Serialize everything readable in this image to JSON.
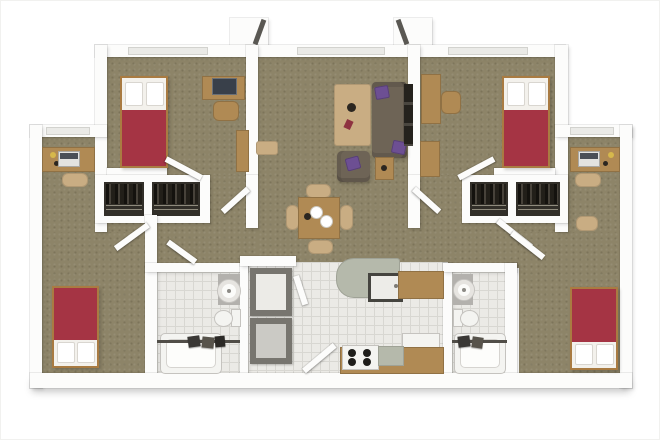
{
  "meta": {
    "description": "3D top-down architectural rendering of a four-bedroom apartment floor plan with central shared living room, dining area, kitchen, two bathrooms, closets and a stacked laundry unit",
    "view": "overhead isometric floor plan, no text labels"
  },
  "colors": {
    "background": "#ffffff",
    "wall": "#fcfcfb",
    "carpet": "#8d8468",
    "tile": "#ebeae6",
    "tile_line": "#d8d7d2",
    "window_fill": "#eaeae7",
    "window_border": "#d2d2ce",
    "bed_red": "#a53444",
    "bed_white": "#f3f1ec",
    "bed_frame": "#a97b42",
    "wood": "#b08a54",
    "wood_light": "#c9ad83",
    "couch": "#6e6456",
    "pillow_purple": "#6d4f93",
    "closet_dark": "#322f29",
    "media_dark": "#25221d",
    "counter_green": "#b5b9ab",
    "appliance_white": "#f4f4f1",
    "fixture_border": "#c5c3bf",
    "unit_frame": "#77756f",
    "unit_panel_light": "#ecebe7",
    "unit_panel_gray": "#cbcac5",
    "monitor_dark": "#39404a",
    "laptop_light": "#e3e3e0",
    "rod_dark": "#514e48",
    "accent_dark": "#5a5853",
    "red_item": "#8e3240",
    "table_item_dark": "#2b2620"
  },
  "rooms": [
    {
      "name": "bedroom-top-left",
      "furniture": [
        "twin-bed-red",
        "desk",
        "computer-monitor",
        "desk-chair",
        "dresser"
      ]
    },
    {
      "name": "bedroom-top-right",
      "furniture": [
        "twin-bed-red",
        "desk",
        "desk-chair",
        "dresser"
      ]
    },
    {
      "name": "living-room",
      "furniture": [
        "sofa-with-purple-pillows",
        "coffee-table",
        "armchair",
        "side-table",
        "media-unit",
        "bench"
      ]
    },
    {
      "name": "dining-area",
      "furniture": [
        "square-dining-table",
        "four-chairs",
        "place-settings"
      ]
    },
    {
      "name": "kitchen",
      "furniture": [
        "island-with-sink",
        "range-with-four-burners",
        "green-counter",
        "wood-counter",
        "refrigerator"
      ]
    },
    {
      "name": "bathroom-left",
      "furniture": [
        "round-sink",
        "toilet",
        "bathtub-with-shower-rod",
        "towels"
      ]
    },
    {
      "name": "bathroom-right",
      "furniture": [
        "round-sink",
        "toilet",
        "bathtub-with-shower-rod",
        "towels"
      ]
    },
    {
      "name": "bedroom-bottom-left",
      "furniture": [
        "twin-bed-red",
        "alcove-desk-with-laptop",
        "desk-chair"
      ]
    },
    {
      "name": "bedroom-bottom-right",
      "furniture": [
        "twin-bed-red",
        "alcove-desk-with-laptop",
        "desk-chair",
        "stool"
      ]
    },
    {
      "name": "closets",
      "furniture": [
        "hanging-clothes",
        "shelves"
      ]
    },
    {
      "name": "laundry-niche",
      "furniture": [
        "stacked-washer-dryer"
      ]
    }
  ]
}
